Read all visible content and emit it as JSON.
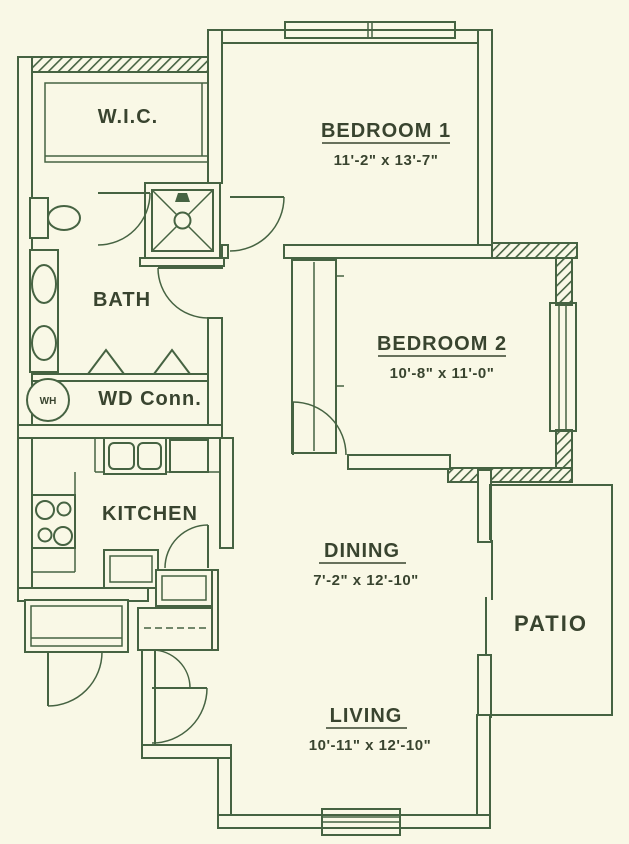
{
  "title": "apartment-floor-plan",
  "colors": {
    "background": "#f9f8e6",
    "wall_line": "#466342",
    "label_text": "#39442f"
  },
  "rooms": {
    "wic": {
      "name": "W.I.C."
    },
    "bedroom1": {
      "name": "BEDROOM 1",
      "dims": "11'-2\" x 13'-7\""
    },
    "bath": {
      "name": "BATH"
    },
    "bedroom2": {
      "name": "BEDROOM 2",
      "dims": "10'-8\" x 11'-0\""
    },
    "wd_conn": {
      "name": "WD Conn."
    },
    "water_heater": {
      "abbr": "WH"
    },
    "kitchen": {
      "name": "KITCHEN"
    },
    "dining": {
      "name": "DINING",
      "dims": "7'-2\" x 12'-10\""
    },
    "patio": {
      "name": "PATIO"
    },
    "living": {
      "name": "LIVING",
      "dims": "10'-11\" x 12'-10\""
    }
  },
  "fixtures": [
    "toilet",
    "vanity-double-sink",
    "shower-stall",
    "water-heater",
    "washer-dryer-bifold-doors",
    "kitchen-double-sink",
    "refrigerator",
    "range-burners",
    "island-counter",
    "bedroom2-closet",
    "coat-closet",
    "pantry",
    "storage-closet",
    "windows",
    "door-swings",
    "sliding-patio-door"
  ]
}
